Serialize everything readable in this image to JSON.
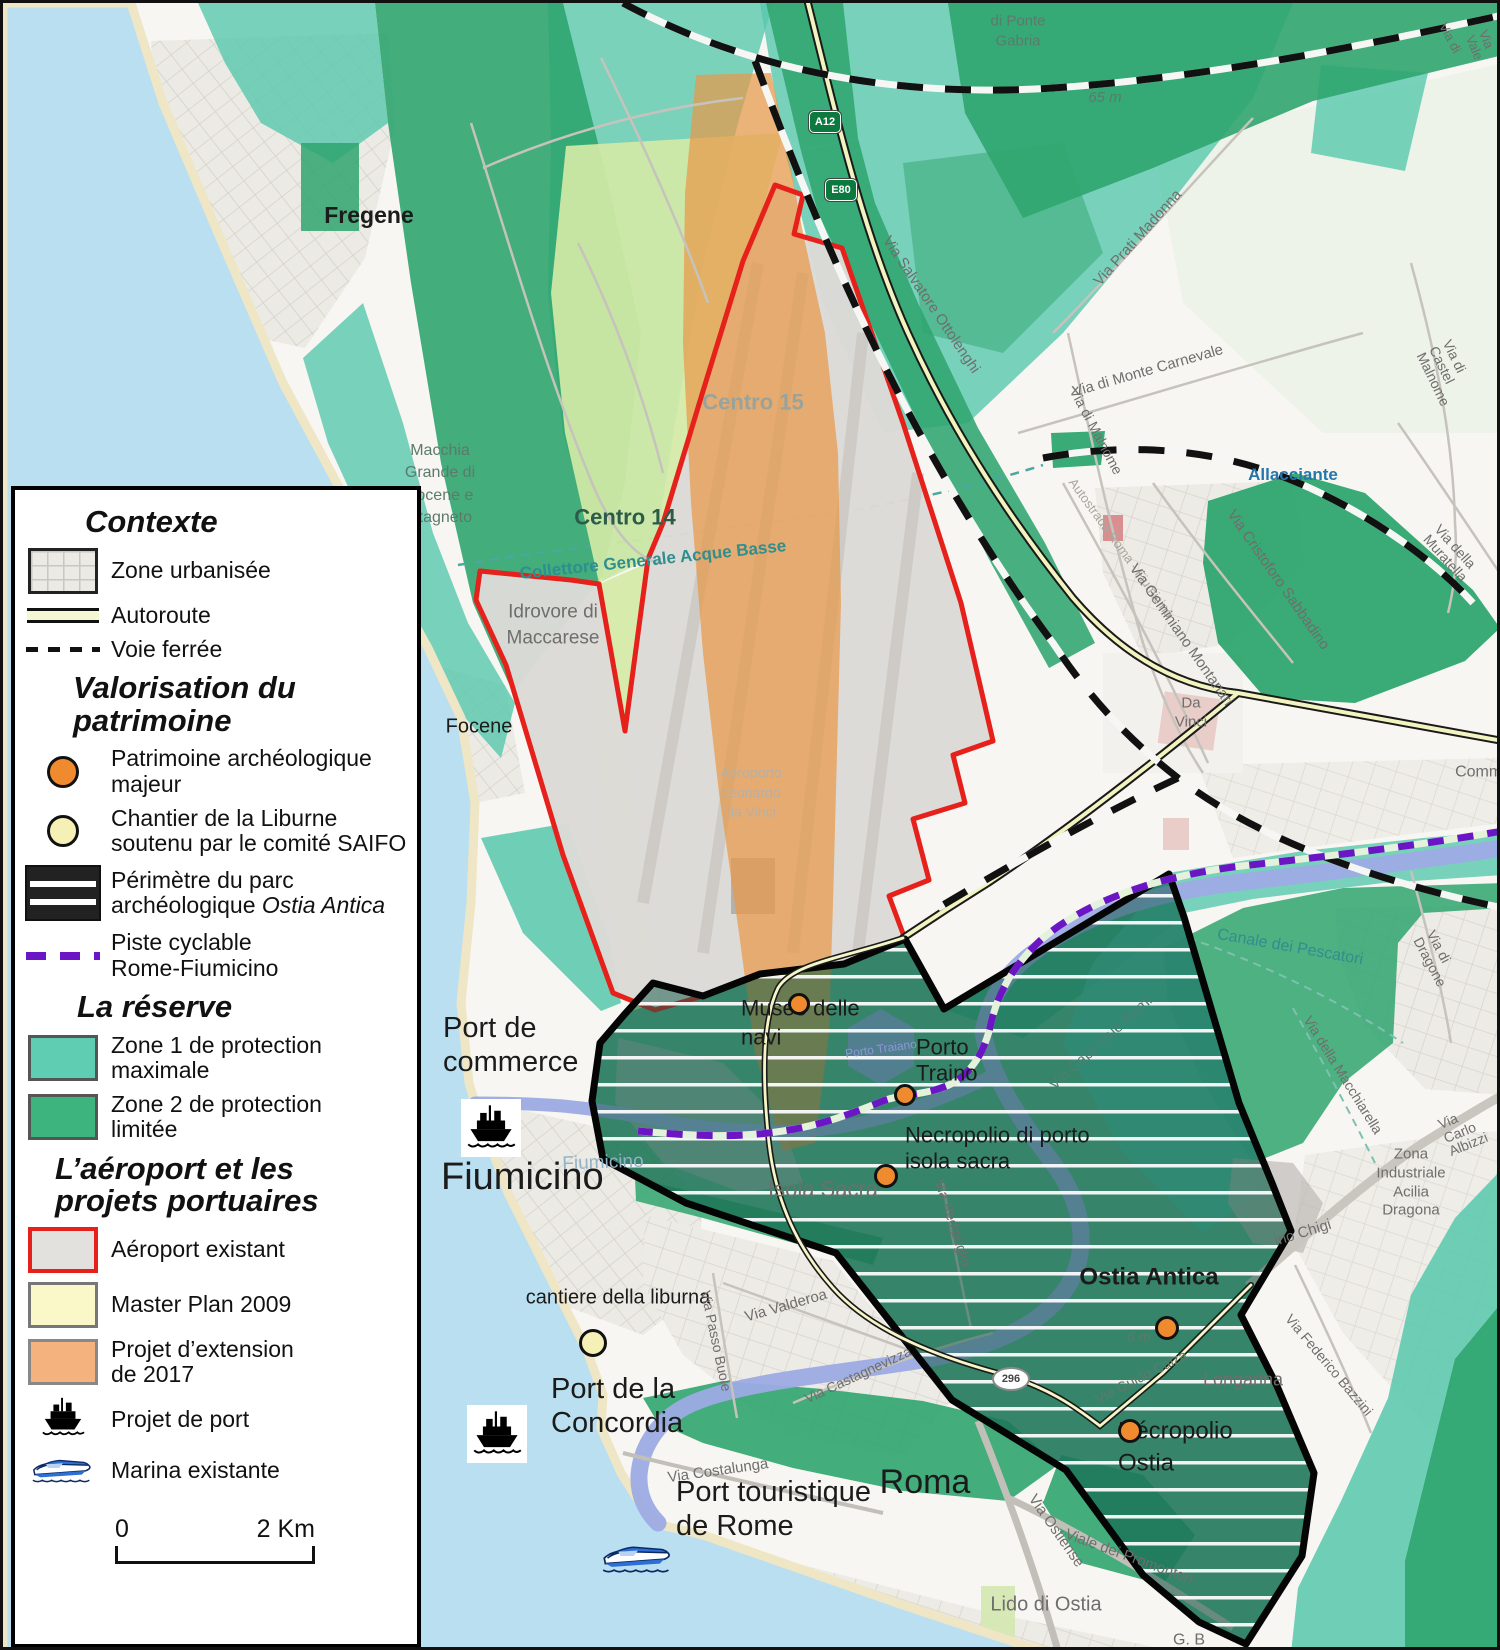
{
  "title": "Carte de la réserve, de l'aéroport et des projets portuaires de Fiumicino - Ostia",
  "colors": {
    "sea": "#b9dff0",
    "land": "#f8f6f2",
    "beach": "#efe6c6",
    "zone1_teal": "#57c8ac",
    "zone2_green": "#2fa56f",
    "masterplan": "#d3e9a6",
    "extension_orange": "#e8994a",
    "airport_gray": "#dcdad7",
    "airport_border_red": "#e6201a",
    "park_boundary": "#050505",
    "river": "#9dabe4",
    "cycleway_purple": "#6a16c4",
    "heritage_orange": "#f08a2e",
    "liburne_yellow": "#f5f0b5"
  },
  "legend": {
    "sections": [
      {
        "title": "Contexte",
        "indent": 70,
        "items": [
          {
            "label": "Zone urbanisée",
            "swatch": "urban"
          },
          {
            "label": "Autoroute",
            "swatch": "highway"
          },
          {
            "label": "Voie ferrée",
            "swatch": "railway"
          }
        ]
      },
      {
        "title": "Valorisation du\npatrimoine",
        "indent": 58,
        "items": [
          {
            "label": "Patrimoine archéologique\nmajeur",
            "swatch": "dot-orange"
          },
          {
            "label": "Chantier de la Liburne\nsoutenu par le comité SAIFO",
            "swatch": "dot-yellow"
          },
          {
            "label": "Périmètre du parc\narchéologique ",
            "label_em": "Ostia Antica",
            "swatch": "park"
          },
          {
            "label": "Piste cyclable\nRome-Fiumicino",
            "swatch": "cycle"
          }
        ]
      },
      {
        "title": "La réserve",
        "indent": 62,
        "items": [
          {
            "label": "Zone 1 de protection\nmaximale",
            "swatch": "zone1"
          },
          {
            "label": "Zone 2 de protection\nlimitée",
            "swatch": "zone2"
          }
        ]
      },
      {
        "title": "L’aéroport et les\nprojets portuaires",
        "indent": 40,
        "items": [
          {
            "label": "Aéroport existant",
            "swatch": "airport"
          },
          {
            "label": "Master Plan 2009",
            "swatch": "masterplan"
          },
          {
            "label": "Projet d’extension\nde 2017",
            "swatch": "extension"
          },
          {
            "label": "Projet de port",
            "swatch": "ship"
          },
          {
            "label": "Marina existante",
            "swatch": "marina"
          }
        ]
      }
    ],
    "scale": {
      "zero": "0",
      "end": "2 Km"
    }
  },
  "map": {
    "labels": [
      {
        "t": "Fregene",
        "x": 366,
        "y": 212,
        "s": 23,
        "c": "dark",
        "w": 600
      },
      {
        "t": "Macchia\nGrande di\nFocene e\nStagneto",
        "x": 437,
        "y": 482,
        "s": 16,
        "c": "greengray",
        "a": "c",
        "lh": 1.4
      },
      {
        "t": "Centro 14",
        "x": 622,
        "y": 514,
        "s": 22,
        "c": "darkgreen",
        "w": 600
      },
      {
        "t": "Centro 15",
        "x": 750,
        "y": 399,
        "s": 22,
        "c": "centro15",
        "w": 600
      },
      {
        "t": "Idrovore di\nMaccarese",
        "x": 550,
        "y": 622,
        "s": 19,
        "c": "gray",
        "a": "c",
        "lh": 1.35
      },
      {
        "t": "Focene",
        "x": 476,
        "y": 724,
        "s": 20,
        "c": "dark"
      },
      {
        "t": "Aeroporto\nLeonardo\nda Vinci",
        "x": 748,
        "y": 790,
        "s": 14,
        "c": "faintair",
        "a": "c",
        "lh": 1.4
      },
      {
        "t": "Da\nVinci",
        "x": 1188,
        "y": 710,
        "s": 15,
        "c": "gray",
        "a": "c",
        "lh": 1.25
      },
      {
        "t": "Allacciante",
        "x": 1290,
        "y": 472,
        "s": 17,
        "c": "blue",
        "w": 700
      },
      {
        "t": "Collettore Generale Acque Basse",
        "x": 650,
        "y": 557,
        "s": 17,
        "c": "teal",
        "w": 600,
        "r": -6
      },
      {
        "t": "di Ponte\nGabria",
        "x": 1015,
        "y": 28,
        "s": 15,
        "c": "greengray",
        "a": "c",
        "lh": 1.3
      },
      {
        "t": "65 m",
        "x": 1102,
        "y": 95,
        "s": 15,
        "c": "greengray",
        "i": 1
      },
      {
        "t": "Via Prati Madonna",
        "x": 1135,
        "y": 235,
        "s": 15,
        "c": "gray",
        "r": -48
      },
      {
        "t": "Via di Monte Carnevale",
        "x": 1145,
        "y": 368,
        "s": 15,
        "c": "gray",
        "r": -16
      },
      {
        "t": "Via di Malnome",
        "x": 1093,
        "y": 428,
        "s": 14,
        "c": "gray",
        "r": 62
      },
      {
        "t": "Via di Castel Malnome",
        "x": 1443,
        "y": 370,
        "s": 14,
        "c": "gray",
        "r": 64
      },
      {
        "t": "Via Salvatore Ottolenghi",
        "x": 928,
        "y": 302,
        "s": 15,
        "c": "gray",
        "r": 56
      },
      {
        "t": "Autostrada Roma - Fiumicino",
        "x": 1118,
        "y": 545,
        "s": 13,
        "c": "faded",
        "r": 54
      },
      {
        "t": "Via Cristoforo Sabbadino",
        "x": 1275,
        "y": 577,
        "s": 15,
        "c": "gray",
        "r": 55
      },
      {
        "t": "Via Geminiano Montanari",
        "x": 1178,
        "y": 632,
        "s": 15,
        "c": "gray",
        "r": 55
      },
      {
        "t": "Via della Muratella",
        "x": 1448,
        "y": 550,
        "s": 14,
        "c": "gray",
        "r": 48
      },
      {
        "t": "Commercio",
        "x": 1493,
        "y": 770,
        "s": 16,
        "c": "gray"
      },
      {
        "t": "Canale dei Pescatori",
        "x": 1287,
        "y": 945,
        "s": 16,
        "c": "teal",
        "r": 10
      },
      {
        "t": "Via di Dragone",
        "x": 1436,
        "y": 960,
        "s": 14,
        "c": "gray",
        "r": 62
      },
      {
        "t": "Via della Macchiarella",
        "x": 1340,
        "y": 1072,
        "s": 14,
        "c": "gray",
        "r": 58
      },
      {
        "t": "Via Carlo Albizzi",
        "x": 1460,
        "y": 1128,
        "s": 14,
        "c": "gray",
        "r": -22
      },
      {
        "t": "Zona Industriale\nAcilia Dragona",
        "x": 1408,
        "y": 1180,
        "s": 15,
        "c": "gray",
        "a": "c",
        "lh": 1.25
      },
      {
        "t": "ino Chigi",
        "x": 1300,
        "y": 1230,
        "s": 15,
        "c": "gray",
        "r": -17
      },
      {
        "t": "Via Federico Bazzini",
        "x": 1326,
        "y": 1362,
        "s": 14,
        "c": "gray",
        "r": 50
      },
      {
        "t": "Longarina",
        "x": 1240,
        "y": 1377,
        "s": 18,
        "c": "gray"
      },
      {
        "t": "Ostia Antica",
        "x": 1146,
        "y": 1274,
        "s": 24,
        "c": "dark",
        "w": 600
      },
      {
        "t": "6 m",
        "x": 1136,
        "y": 1334,
        "s": 14,
        "c": "greengray",
        "i": 1
      },
      {
        "t": "Via Guido Calza",
        "x": 1138,
        "y": 1374,
        "s": 14,
        "c": "greengray",
        "r": -27
      },
      {
        "t": "Nécropolio\nOstia",
        "x": 1115,
        "y": 1445,
        "s": 24,
        "c": "dark",
        "a": "l",
        "lh": 1.35
      },
      {
        "t": "Lido di Ostia",
        "x": 1043,
        "y": 1602,
        "s": 20,
        "c": "gray"
      },
      {
        "t": "G. B",
        "x": 1186,
        "y": 1638,
        "s": 16,
        "c": "gray"
      },
      {
        "t": "Viale dei Promontori",
        "x": 1126,
        "y": 1554,
        "s": 15,
        "c": "gray",
        "r": 20
      },
      {
        "t": "Via Ostiense",
        "x": 1053,
        "y": 1528,
        "s": 15,
        "c": "gray",
        "r": 55
      },
      {
        "t": "Roma",
        "x": 922,
        "y": 1480,
        "s": 34,
        "c": "dark",
        "w": 500
      },
      {
        "t": "Port touristique\nde Rome",
        "x": 673,
        "y": 1506,
        "s": 29,
        "c": "dark",
        "a": "l",
        "lh": 1.18,
        "w": 500
      },
      {
        "t": "Port de la\nConcordia",
        "x": 548,
        "y": 1403,
        "s": 29,
        "c": "dark",
        "a": "l",
        "lh": 1.18,
        "w": 500
      },
      {
        "t": "cantiere della liburna",
        "x": 615,
        "y": 1295,
        "s": 20,
        "c": "dark",
        "w": 500
      },
      {
        "t": "Port de\ncommerce",
        "x": 440,
        "y": 1042,
        "s": 29,
        "c": "dark",
        "a": "l",
        "lh": 1.18,
        "w": 500
      },
      {
        "t": "Fiumicino",
        "x": 438,
        "y": 1175,
        "s": 38,
        "c": "dark",
        "a": "l",
        "w": 500
      },
      {
        "t": "Fiumicino",
        "x": 600,
        "y": 1160,
        "s": 19,
        "c": "canal",
        "r": -2
      },
      {
        "t": "Isola Sacra",
        "x": 820,
        "y": 1186,
        "s": 22,
        "c": "gray"
      },
      {
        "t": "Via Valderoa",
        "x": 783,
        "y": 1303,
        "s": 15,
        "c": "gray",
        "r": -16
      },
      {
        "t": "Via Passo Buole",
        "x": 713,
        "y": 1338,
        "s": 14,
        "c": "gray",
        "r": 78
      },
      {
        "t": "Via Castagnevizza",
        "x": 855,
        "y": 1372,
        "s": 14,
        "c": "gray",
        "r": -25
      },
      {
        "t": "Via Costalunga",
        "x": 715,
        "y": 1468,
        "s": 15,
        "c": "gray",
        "r": -8
      },
      {
        "t": "Museo delle\nnavi",
        "x": 738,
        "y": 1020,
        "s": 22,
        "c": "dark",
        "a": "l",
        "lh": 1.3,
        "w": 500
      },
      {
        "t": "Porto\nTraino",
        "x": 913,
        "y": 1058,
        "s": 22,
        "c": "dark",
        "a": "l",
        "lh": 1.2,
        "w": 500
      },
      {
        "t": "Necropolio di porto\nisola sacra",
        "x": 902,
        "y": 1146,
        "s": 22,
        "c": "dark",
        "a": "l",
        "lh": 1.2,
        "w": 500
      },
      {
        "t": "Via Capo Due Rami",
        "x": 1098,
        "y": 1040,
        "s": 15,
        "c": "greengray2",
        "r": -42
      },
      {
        "t": "Via Redipuglia",
        "x": 950,
        "y": 1220,
        "s": 14,
        "c": "gray",
        "r": 72
      },
      {
        "t": "Porto Traiano",
        "x": 878,
        "y": 1046,
        "s": 12,
        "c": "periwinkle",
        "r": -8
      },
      {
        "t": "Via di",
        "x": 1447,
        "y": 35,
        "s": 13,
        "c": "gray",
        "r": 62
      },
      {
        "t": "Via Vale",
        "x": 1478,
        "y": 42,
        "s": 13,
        "c": "gray",
        "r": 68
      }
    ],
    "label_colors": {
      "dark": "#1b1b1b",
      "gray": "#6f6e6c",
      "faded": "#aaa69e",
      "faintair": "#b5b0a8",
      "greengray": "#5c7a6b",
      "greengray2": "#4d7e70",
      "teal": "#2f8e8e",
      "blue": "#2577a9",
      "canal": "#93b2c6",
      "periwinkle": "#8b97d6",
      "darkgreen": "#2c5c49",
      "centro15": "#9aa39b"
    },
    "markers": [
      {
        "type": "orange",
        "name": "museo-delle-navi",
        "x": 796,
        "y": 1001,
        "r": 11
      },
      {
        "type": "orange",
        "name": "porto-traino",
        "x": 902,
        "y": 1092,
        "r": 11
      },
      {
        "type": "orange",
        "name": "necropolio-di-porto",
        "x": 883,
        "y": 1173,
        "r": 12
      },
      {
        "type": "orange",
        "name": "ostia-antica",
        "x": 1164,
        "y": 1325,
        "r": 12
      },
      {
        "type": "orange",
        "name": "necropolio-ostia",
        "x": 1127,
        "y": 1428,
        "r": 12
      },
      {
        "type": "yellow",
        "name": "cantiere-liburna",
        "x": 590,
        "y": 1340,
        "r": 14
      }
    ],
    "shields": [
      {
        "label": "A12",
        "kind": "green",
        "x": 822,
        "y": 118
      },
      {
        "label": "E80",
        "kind": "green",
        "x": 838,
        "y": 186
      },
      {
        "label": "296",
        "kind": "white",
        "x": 1005,
        "y": 1374
      }
    ]
  }
}
